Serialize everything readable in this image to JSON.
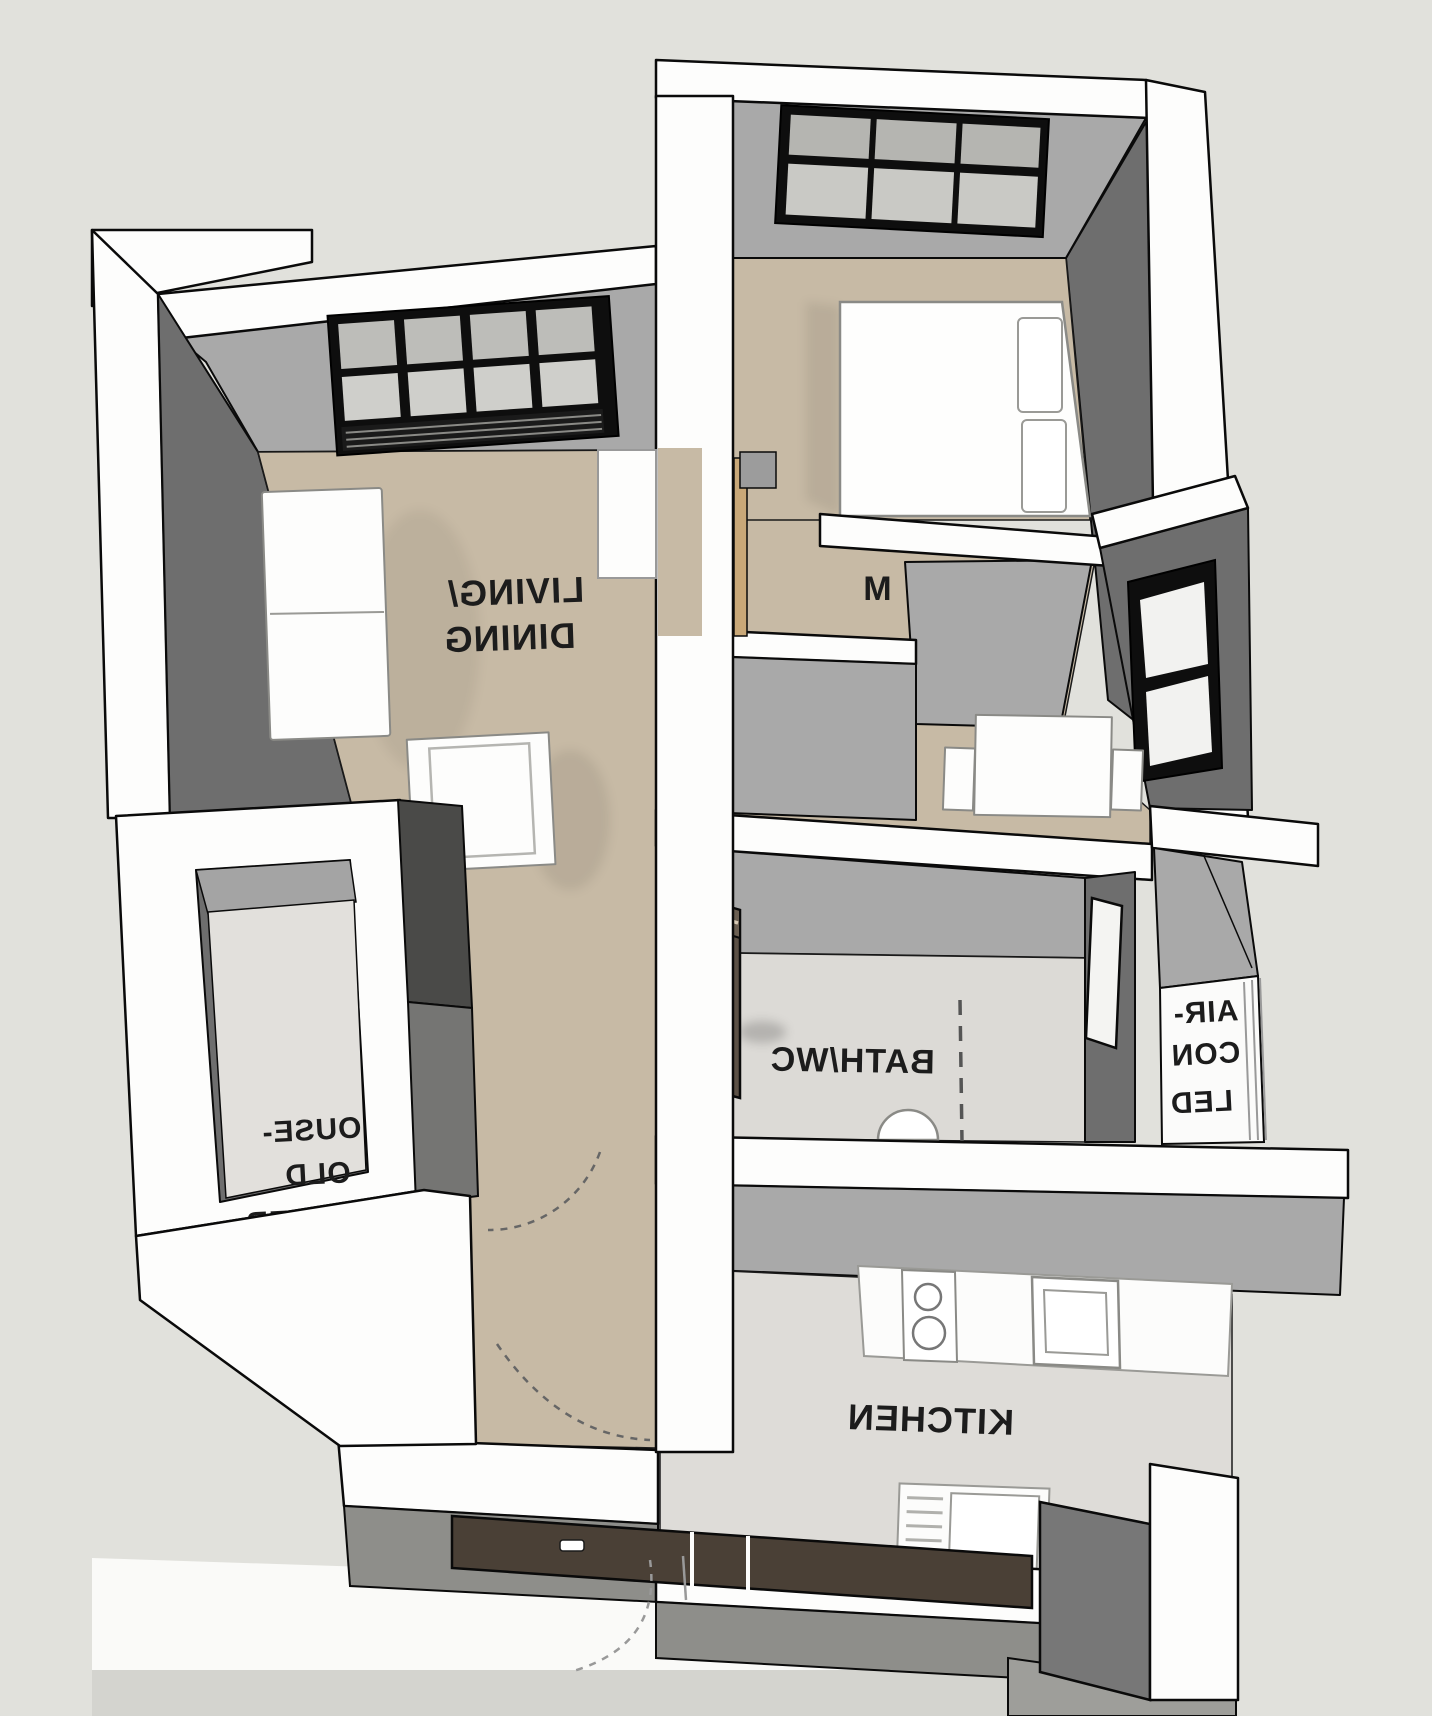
{
  "scene": {
    "type": "3d-floor-plan-render",
    "view": "bird's-eye axonometric; room labels on floor appear mirrored",
    "background": "#E1E1DC"
  },
  "palette": {
    "wall_top": "#FDFDFC",
    "wall_face": "#A9A9A9",
    "wall_face_dark": "#6E6E6E",
    "floor_wood": "#C7BAA5",
    "floor_tile": "#DEDCD8",
    "window_frame": "#0E0E0E",
    "glass": "#C6C6C2",
    "entry_door": "#4A4036",
    "wood_door_leaf": "#C9A878",
    "cabinet": "#5C5146",
    "label_color": "#1C1C1C"
  },
  "rooms": {
    "living_dining": {
      "name": "Living/Dining",
      "lines": [
        "LIVING/",
        "DINING"
      ],
      "floor": "wood",
      "furniture": [
        "sofa",
        "coffee-table"
      ],
      "window": "4x2 panes with louvres"
    },
    "bedroom": {
      "name": "Bedroom",
      "visible_label": "M",
      "floor": "wood",
      "furniture": [
        "double-bed",
        "two-pillows"
      ],
      "window": "3x2 panes"
    },
    "bath": {
      "label": "BATH/WC",
      "floor": "tile",
      "fixtures": [
        "basin-semicircle",
        "shower-dashed-screen",
        "brown-cabinet",
        "slit-window"
      ]
    },
    "kitchen": {
      "label": "KITCHEN",
      "floor": "tile",
      "fixtures": [
        "counter",
        "hob-two-burners",
        "sink",
        "drying-rack",
        "refrigerator"
      ]
    },
    "shelter": {
      "label": "HOUSE-HOLD SHELTER",
      "visible_lines": [
        "OUSE-",
        "OLD",
        "HELTER"
      ]
    },
    "aircon": {
      "label": "AIR-CON LEDGE",
      "visible_lines": [
        "AIR-",
        "CON",
        "LED"
      ]
    },
    "nook": {
      "name": "corridor dining nook",
      "furniture": [
        "table",
        "chair",
        "chair"
      ]
    }
  },
  "doors": {
    "entrance": "dark timber entrance door at bottom wall with handle",
    "bedroom_leaf": "open timber leaf in corridor",
    "swing_arcs": 3
  }
}
